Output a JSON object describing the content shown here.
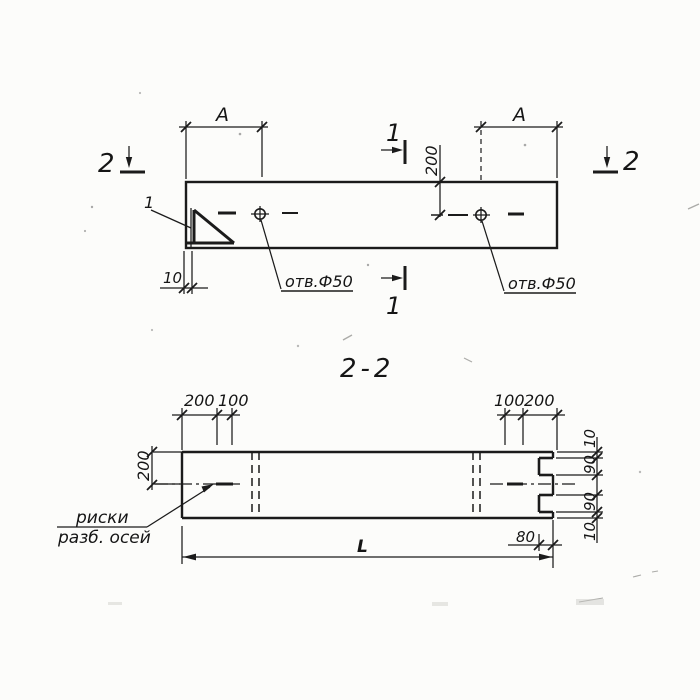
{
  "top_view": {
    "dim_a_left": "A",
    "dim_a_right": "A",
    "dim_200": "200",
    "dim_10": "10",
    "detail_label": "1",
    "hole_label_left": "отв.Ф50",
    "hole_label_right": "отв.Ф50",
    "section1_top": "1",
    "section1_bottom": "1",
    "section2_left": "2",
    "section2_right": "2"
  },
  "section_view": {
    "title": "2-2",
    "dim_left_200": "200",
    "dim_left_100": "100",
    "dim_right_100": "100",
    "dim_right_200": "200",
    "dim_height_200": "200",
    "dim_chain": {
      "top_10": "10",
      "top_90": "90",
      "bottom_90": "90",
      "bottom_10": "10"
    },
    "dim_80": "80",
    "dim_length": "L",
    "note_line1": "риски",
    "note_line2": "разб. осей"
  }
}
